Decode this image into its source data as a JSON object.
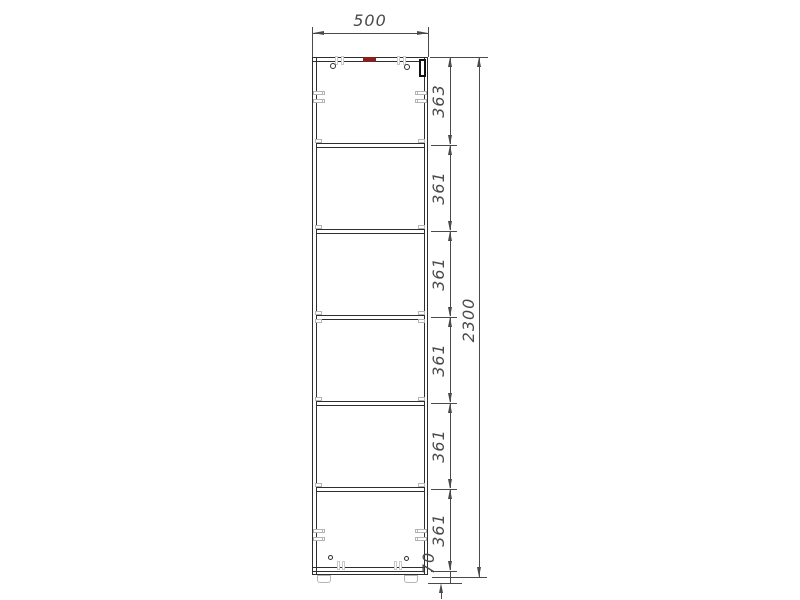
{
  "drawing": {
    "kind": "cabinet-front-elevation",
    "shelf_count": 5,
    "colors": {
      "outline": "#2e2e2e",
      "dimension": "#4a4a4a",
      "hardware": "#b4b4b4",
      "marker_red": "#8b1f1f",
      "hinge_black": "#111111",
      "background": "#ffffff"
    }
  },
  "dims": {
    "width": "500",
    "height": "2300",
    "segments": [
      "363",
      "361",
      "361",
      "361",
      "361",
      "361"
    ],
    "plinth": "70"
  }
}
